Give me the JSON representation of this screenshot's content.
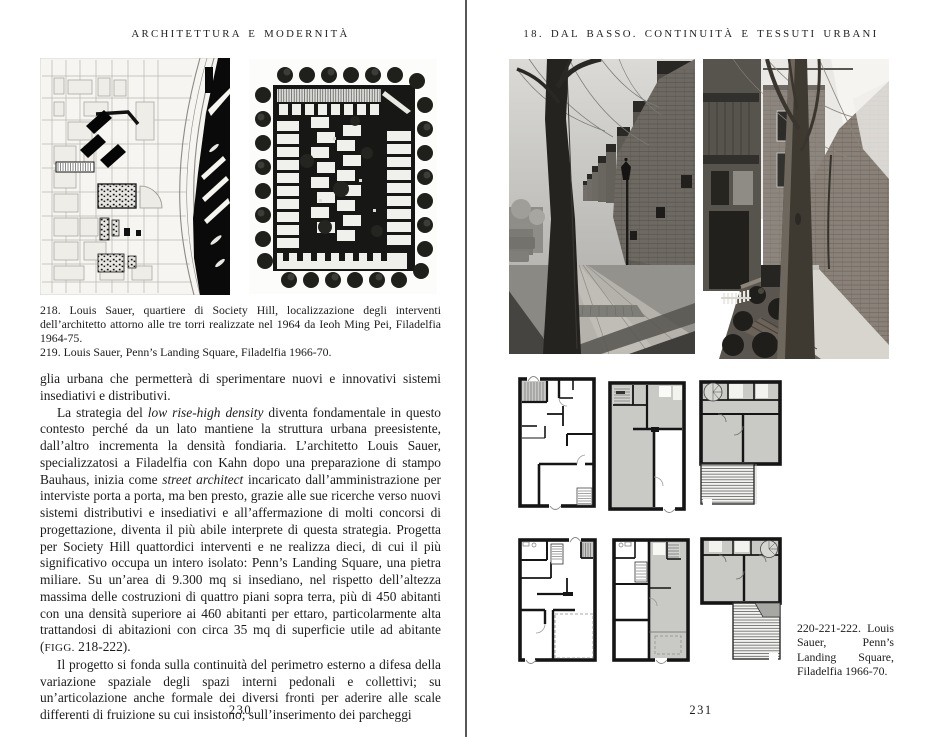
{
  "meta": {
    "paper_color": "#ffffff",
    "ink_color": "#1c1c1c",
    "gutter_divider_color": "#585858"
  },
  "left_page": {
    "header": "ARCHITETTURA E MODERNITÀ",
    "captions": {
      "item218": "218. Louis Sauer, quartiere di Society Hill, localizzazione degli interventi dell’architetto attorno alle tre torri realizzate nel 1964 da Ieoh Ming Pei, Filadelfia 1964-75.",
      "item219": "219. Louis Sauer, Penn’s Landing Square, Filadelfia 1966-70."
    },
    "body": {
      "para1": "glia urbana che permetterà di sperimentare nuovi e innovativi sistemi insediativi e distributivi.",
      "para2": {
        "t1": "La strategia del ",
        "i1": "low rise-high density",
        "t2": " diventa fondamentale in questo contesto perché da un lato mantiene la struttura urbana preesistente, dall’altro incrementa la densità fondiaria. L’architetto Louis Sauer, specializzatosi a Filadelfia con Kahn dopo una preparazione di stampo Bauhaus, inizia come ",
        "i2": "street architect",
        "t3": " incaricato dall’amministrazione per interviste porta a porta, ma ben presto, grazie alle sue ricerche verso nuovi sistemi distributivi e insediativi e all’affermazione di molti concorsi di progettazione, diventa il più abile interprete di questa strategia. Progetta per Society Hill quattordici interventi e ne realizza dieci, di cui il più significativo occupa un intero isolato: Penn’s Landing Square, una pietra miliare. Su un’area di 9.300 mq si insediano, nel rispetto dell’altezza massima delle costruzioni di quattro piani sopra terra, più di 450 abitanti con una densità superiore ai 460 abitanti per ettaro, particolarmente alta trattandosi di abitazioni con circa 35 mq di superficie utile ad abitante (",
        "sc": "FIGG.",
        "t4": " 218-222)."
      },
      "para3": "Il progetto si fonda sulla continuità del perimetro esterno a difesa della variazione spaziale degli spazi interni pedonali e collettivi; su un’articolazione anche formale dei diversi fronti per aderire alle scale differenti di fruizione su cui insistono; sull’inserimento dei parcheggi"
    },
    "page_number": "230"
  },
  "right_page": {
    "header": "18. DAL BASSO. CONTINUITÀ E TESSUTI URBANI",
    "caption": "220-221-222. Louis Sauer, Penn’s Landing Square, Filadelfia 1966-70.",
    "page_number": "231"
  }
}
